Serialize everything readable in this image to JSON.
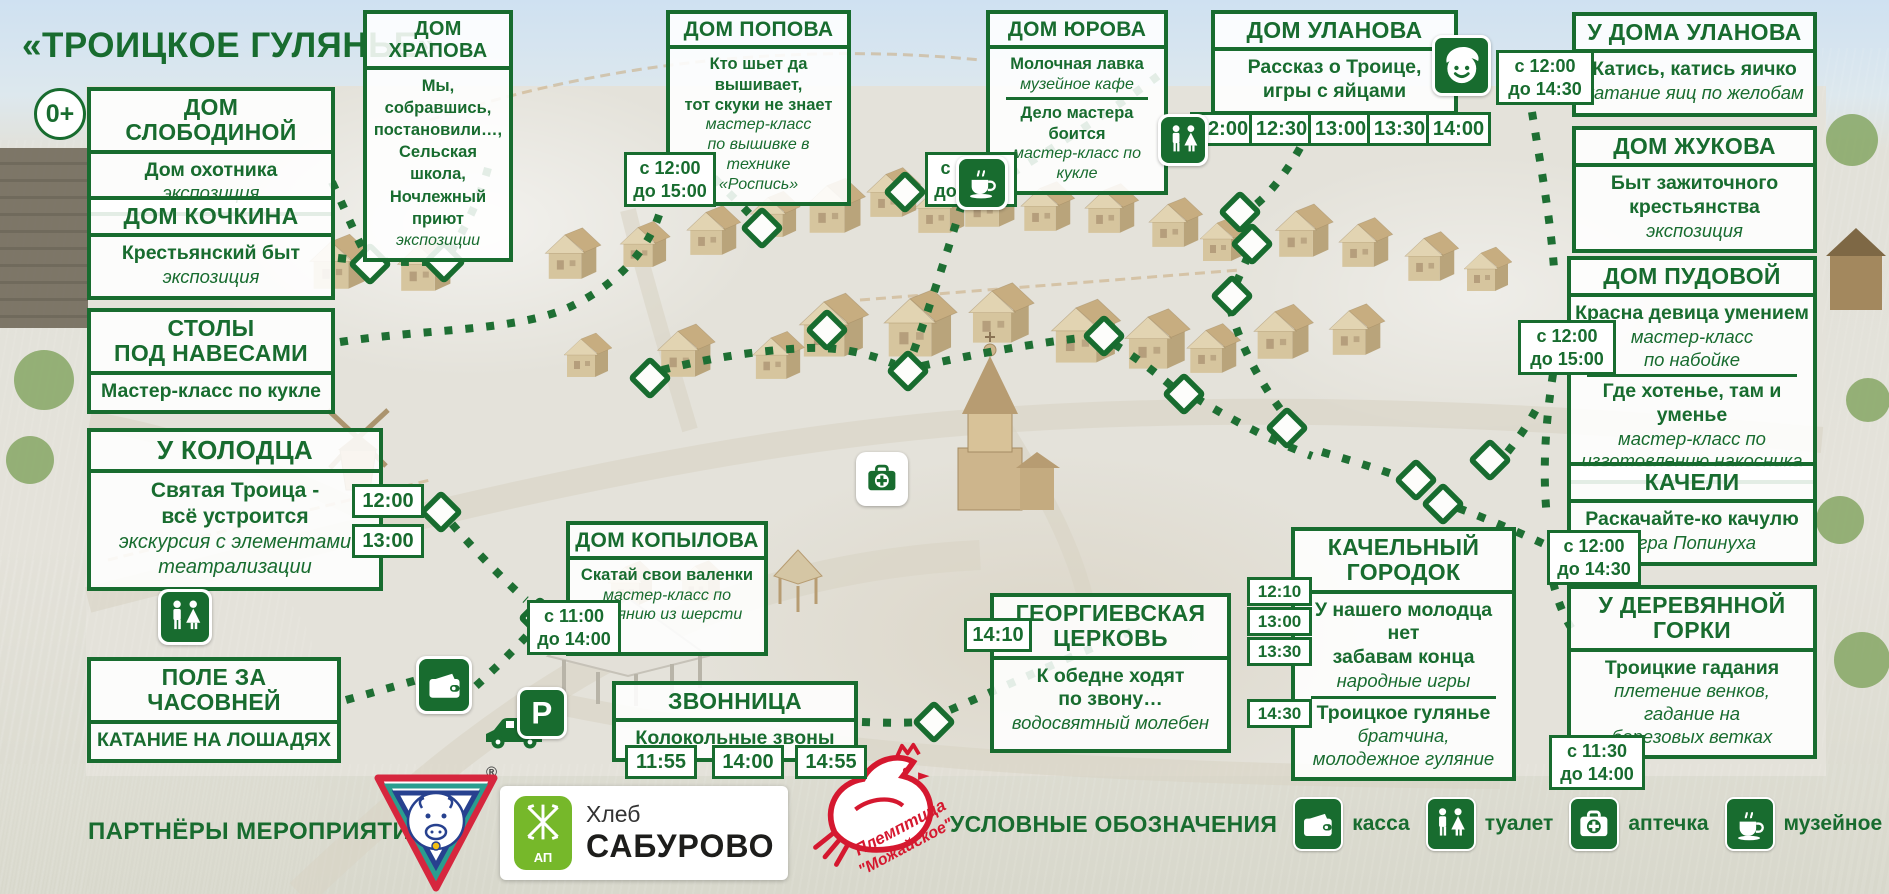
{
  "title": "«ТРОИЦКОЕ ГУЛЯНЬЕ»",
  "age_badge": "0+",
  "colors": {
    "green": "#186c2f",
    "saburovo_green": "#76b82a",
    "bird_red": "#d5182f"
  },
  "boxes": [
    {
      "id": "slobodinoy",
      "x": 87,
      "y": 87,
      "w": 248,
      "h": 96,
      "title": "ДОМ СЛОБОДИНОЙ",
      "rows": [
        {
          "t": "Дом охотника",
          "s": "b"
        },
        {
          "t": "экспозиция",
          "s": "i"
        }
      ]
    },
    {
      "id": "kochkina",
      "x": 87,
      "y": 196,
      "w": 248,
      "h": 93,
      "title": "ДОМ КОЧКИНА",
      "rows": [
        {
          "t": "Крестьянский быт",
          "s": "b"
        },
        {
          "t": "экспозиция",
          "s": "i"
        }
      ]
    },
    {
      "id": "stoly",
      "x": 87,
      "y": 308,
      "w": 248,
      "h": 97,
      "title": "СТОЛЫ\nПОД НАВЕСАМИ",
      "rows": [
        {
          "t": "Мастер-класс по кукле",
          "s": "b"
        }
      ]
    },
    {
      "id": "kolodtsa",
      "x": 87,
      "y": 428,
      "w": 296,
      "h": 150,
      "title": "У КОЛОДЦА",
      "rows": [
        {
          "t": "Святая Троица -",
          "s": "b"
        },
        {
          "t": "всё устроится",
          "s": "b"
        },
        {
          "t": "экскурсия с элементами",
          "s": "i"
        },
        {
          "t": "театрализации",
          "s": "i"
        }
      ]
    },
    {
      "id": "pole",
      "x": 87,
      "y": 657,
      "w": 254,
      "h": 90,
      "title": "ПОЛЕ ЗА ЧАСОВНЕЙ",
      "rows": [
        {
          "t": "КАТАНИЕ НА ЛОШАДЯХ",
          "s": "b"
        }
      ]
    },
    {
      "id": "khrapova",
      "x": 363,
      "y": 10,
      "w": 150,
      "h": 178,
      "title": "ДОМ ХРАПОВА",
      "rows": [
        {
          "t": "Мы, собравшись,",
          "s": "b"
        },
        {
          "t": "постановили…,",
          "s": "b"
        },
        {
          "t": "Сельская школа,",
          "s": "b"
        },
        {
          "t": "Ночлежный приют",
          "s": "b"
        },
        {
          "t": "экспозиции",
          "s": "i"
        }
      ]
    },
    {
      "id": "popova",
      "x": 666,
      "y": 10,
      "w": 185,
      "h": 164,
      "title": "ДОМ ПОПОВА",
      "rows": [
        {
          "t": "Кто шьет да вышивает,",
          "s": "b"
        },
        {
          "t": "тот скуки не знает",
          "s": "b"
        },
        {
          "t": "мастер-класс",
          "s": "i"
        },
        {
          "t": "по вышивке в технике",
          "s": "i"
        },
        {
          "t": "«Роспись»",
          "s": "i"
        }
      ]
    },
    {
      "id": "yurova",
      "x": 986,
      "y": 10,
      "w": 182,
      "h": 133,
      "title": "ДОМ ЮРОВА",
      "rows": [
        {
          "t": "Молочная лавка",
          "s": "b"
        },
        {
          "t": "музейное кафе",
          "s": "i"
        },
        {
          "d": 1
        },
        {
          "t": "Дело мастера боится",
          "s": "b"
        },
        {
          "t": "мастер-класс по кукле",
          "s": "i"
        }
      ]
    },
    {
      "id": "ulanova",
      "x": 1211,
      "y": 10,
      "w": 247,
      "h": 102,
      "title": "ДОМ УЛАНОВА",
      "rows": [
        {
          "t": "Рассказ о Троице,",
          "s": "b"
        },
        {
          "t": "игры с яйцами",
          "s": "b"
        }
      ]
    },
    {
      "id": "u-doma-ulanova",
      "x": 1572,
      "y": 12,
      "w": 245,
      "h": 105,
      "title": "У ДОМА УЛАНОВА",
      "rows": [
        {
          "t": "Катись, катись яичко",
          "s": "b"
        },
        {
          "t": "катание яиц по желобам",
          "s": "i"
        }
      ]
    },
    {
      "id": "zhukova",
      "x": 1572,
      "y": 126,
      "w": 245,
      "h": 118,
      "title": "ДОМ ЖУКОВА",
      "rows": [
        {
          "t": "Быт зажиточного",
          "s": "b"
        },
        {
          "t": "крестьянства",
          "s": "b"
        },
        {
          "t": "экспозиция",
          "s": "i"
        }
      ]
    },
    {
      "id": "pudovoy",
      "x": 1567,
      "y": 256,
      "w": 250,
      "h": 199,
      "title": "ДОМ ПУДОВОЙ",
      "rows": [
        {
          "t": "Красна девица умением",
          "s": "b"
        },
        {
          "t": "мастер-класс",
          "s": "i"
        },
        {
          "t": "по набойке",
          "s": "i"
        },
        {
          "d": 1
        },
        {
          "t": "Где хотенье, там и уменье",
          "s": "b"
        },
        {
          "t": "мастер-класс по",
          "s": "i"
        },
        {
          "t": "изготовлению накосника",
          "s": "i"
        }
      ]
    },
    {
      "id": "kacheli",
      "x": 1567,
      "y": 462,
      "w": 250,
      "h": 97,
      "title": "КАЧЕЛИ",
      "rows": [
        {
          "t": "Раскачайте-ко качулю",
          "s": "b"
        },
        {
          "t": "игра Попинуха",
          "s": "i"
        }
      ]
    },
    {
      "id": "gorki",
      "x": 1567,
      "y": 585,
      "w": 250,
      "h": 158,
      "title": "У ДЕРЕВЯННОЙ\nГОРКИ",
      "rows": [
        {
          "t": "Троицкие гадания",
          "s": "b"
        },
        {
          "t": "плетение венков,",
          "s": "i"
        },
        {
          "t": "гадание на",
          "s": "i"
        },
        {
          "t": "березовых ветках",
          "s": "i"
        }
      ]
    },
    {
      "id": "kopylova",
      "x": 566,
      "y": 521,
      "w": 202,
      "h": 135,
      "title": "ДОМ КОПЫЛОВА",
      "rows": [
        {
          "t": "Скатай свои валенки",
          "s": "b"
        },
        {
          "t": "мастер-класс по",
          "s": "i"
        },
        {
          "t": "валянию из шерсти",
          "s": "i"
        }
      ]
    },
    {
      "id": "zvonnitsa",
      "x": 612,
      "y": 681,
      "w": 246,
      "h": 80,
      "title": "ЗВОННИЦА",
      "rows": [
        {
          "t": "Колокольные звоны",
          "s": "b"
        }
      ]
    },
    {
      "id": "tserkov",
      "x": 990,
      "y": 593,
      "w": 241,
      "h": 160,
      "title": "ГЕОРГИЕВСКАЯ\nЦЕРКОВЬ",
      "rows": [
        {
          "t": "К обедне ходят",
          "s": "b"
        },
        {
          "t": "по звону…",
          "s": "b"
        },
        {
          "t": "водосвятный молебен",
          "s": "i"
        }
      ]
    },
    {
      "id": "gorodok",
      "x": 1291,
      "y": 527,
      "w": 225,
      "h": 229,
      "title": "КАЧЕЛЬНЫЙ\nГОРОДОК",
      "rows": [
        {
          "t": "У нашего молодца нет",
          "s": "b"
        },
        {
          "t": "забавам конца",
          "s": "b"
        },
        {
          "t": "народные игры",
          "s": "i"
        },
        {
          "d": 1
        },
        {
          "t": "Троицкое гулянье",
          "s": "b"
        },
        {
          "t": "братчина,",
          "s": "i"
        },
        {
          "t": "молодежное гуляние",
          "s": "i"
        }
      ]
    }
  ],
  "badges": [
    {
      "id": "khrapova-hours",
      "l1": "с 12:00",
      "l2": "до 15:00",
      "x": 624,
      "y": 152,
      "w": 78
    },
    {
      "id": "popova-hours",
      "l1": "с 13:00",
      "l2": "до 16:00",
      "x": 925,
      "y": 152,
      "w": 78
    },
    {
      "id": "ulanova-yard-hours",
      "l1": "с 12:00",
      "l2": "до 14:30",
      "x": 1496,
      "y": 50,
      "w": 84
    },
    {
      "id": "pudovoy-hours",
      "l1": "с 12:00",
      "l2": "до 15:00",
      "x": 1518,
      "y": 320,
      "w": 84
    },
    {
      "id": "kacheli-hours",
      "l1": "с 12:00",
      "l2": "до 14:30",
      "x": 1547,
      "y": 530,
      "w": 80
    },
    {
      "id": "gorki-hours",
      "l1": "с 11:30",
      "l2": "до 14:00",
      "x": 1549,
      "y": 735,
      "w": 82
    },
    {
      "id": "kopylova-hours",
      "l1": "с 11:00",
      "l2": "до 14:00",
      "x": 527,
      "y": 600,
      "w": 80
    }
  ],
  "time_chips": [
    {
      "g": "kolodtsa",
      "t": "12:00",
      "x": 352,
      "y": 484,
      "w": 62
    },
    {
      "g": "kolodtsa",
      "t": "13:00",
      "x": 352,
      "y": 524,
      "w": 62
    },
    {
      "g": "ulanova",
      "t": "12:00",
      "x": 1190,
      "y": 112,
      "w": 55
    },
    {
      "g": "ulanova",
      "t": "12:30",
      "x": 1249,
      "y": 112,
      "w": 55
    },
    {
      "g": "ulanova",
      "t": "13:00",
      "x": 1308,
      "y": 112,
      "w": 55
    },
    {
      "g": "ulanova",
      "t": "13:30",
      "x": 1367,
      "y": 112,
      "w": 55
    },
    {
      "g": "ulanova",
      "t": "14:00",
      "x": 1426,
      "y": 112,
      "w": 55
    },
    {
      "g": "zvonnitsa",
      "t": "11:55",
      "x": 625,
      "y": 745,
      "w": 62
    },
    {
      "g": "zvonnitsa",
      "t": "14:00",
      "x": 712,
      "y": 745,
      "w": 62
    },
    {
      "g": "zvonnitsa",
      "t": "14:55",
      "x": 795,
      "y": 745,
      "w": 62
    },
    {
      "g": "tserkov",
      "t": "14:10",
      "x": 964,
      "y": 618,
      "w": 58
    },
    {
      "g": "gorodok",
      "t": "12:10",
      "x": 1247,
      "y": 577,
      "w": 55,
      "sm": 1
    },
    {
      "g": "gorodok",
      "t": "13:00",
      "x": 1247,
      "y": 607,
      "w": 55,
      "sm": 1
    },
    {
      "g": "gorodok",
      "t": "13:30",
      "x": 1247,
      "y": 637,
      "w": 55,
      "sm": 1
    },
    {
      "g": "gorodok",
      "t": "14:30",
      "x": 1247,
      "y": 699,
      "w": 55,
      "sm": 1
    }
  ],
  "map_icons": [
    {
      "type": "coffee",
      "x": 956,
      "y": 156,
      "s": 52,
      "v": "card"
    },
    {
      "type": "wc",
      "x": 1158,
      "y": 114,
      "s": 50,
      "v": "card"
    },
    {
      "type": "wc",
      "x": 158,
      "y": 589,
      "s": 54,
      "v": "card"
    },
    {
      "type": "firstaid",
      "x": 856,
      "y": 452,
      "s": 52,
      "v": "light"
    },
    {
      "type": "wallet",
      "x": 416,
      "y": 656,
      "s": 56,
      "v": "card"
    },
    {
      "type": "kid",
      "x": 1432,
      "y": 35,
      "s": 53,
      "v": "green"
    },
    {
      "type": "parking",
      "x": 517,
      "y": 687,
      "s": 44,
      "v": "green"
    }
  ],
  "legend": {
    "label": "УСЛОВНЫЕ ОБОЗНАЧЕНИЯ",
    "items": [
      {
        "icon": "wallet",
        "label": "касса"
      },
      {
        "icon": "wc",
        "label": "туалет"
      },
      {
        "icon": "firstaid",
        "label": "аптечка"
      },
      {
        "icon": "coffee",
        "label": "музейное кафе"
      }
    ]
  },
  "partners": {
    "label": "ПАРТНЁРЫ МЕРОПРИЯТИЯ",
    "reg_mark": "®",
    "saburovo": {
      "line1": "Хлеб",
      "line2": "САБУРОВО",
      "emblem": "АП"
    },
    "plemptitsa": {
      "line1": "Племптица",
      "line2": "\"Можайское\""
    }
  }
}
